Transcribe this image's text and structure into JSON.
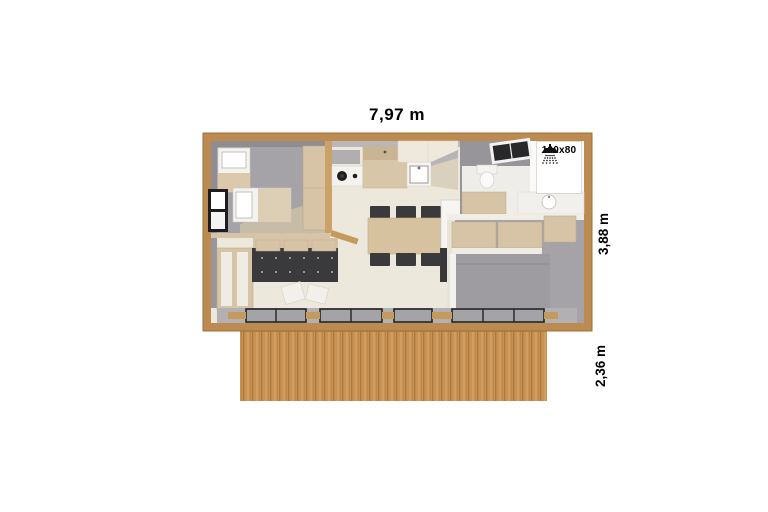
{
  "page": {
    "type": "mobile-home floor plan, top-down 3D view with wooden terrace",
    "background": "#ffffff"
  },
  "dimensions": {
    "width_label": "7,97 m",
    "depth_label": "3,88 m",
    "terrace_depth_label": "2,36 m"
  },
  "shower": {
    "size_label": "100x80",
    "icon": "shower-icon"
  },
  "rooms": [
    {
      "name": "twin-bedroom",
      "position": "top-left"
    },
    {
      "name": "living-area",
      "position": "bottom-left"
    },
    {
      "name": "kitchen",
      "position": "top-center"
    },
    {
      "name": "dining-area",
      "position": "center"
    },
    {
      "name": "bathroom",
      "position": "top-right"
    },
    {
      "name": "master-bedroom",
      "position": "right"
    },
    {
      "name": "terrace-deck",
      "position": "bottom"
    }
  ],
  "colors": {
    "frame_wood": "#bc8b51",
    "deck_wood": "#c89255",
    "interior_floor": "#ece8db",
    "wall_gray": "#a5a3a7",
    "furniture_beige": "#d7c4a6",
    "sofa_charcoal": "#3a3a3c",
    "bed_gray": "#9e9ca0",
    "fixture_white": "#ffffff",
    "window_black": "#232325",
    "label_text": "#000000"
  }
}
